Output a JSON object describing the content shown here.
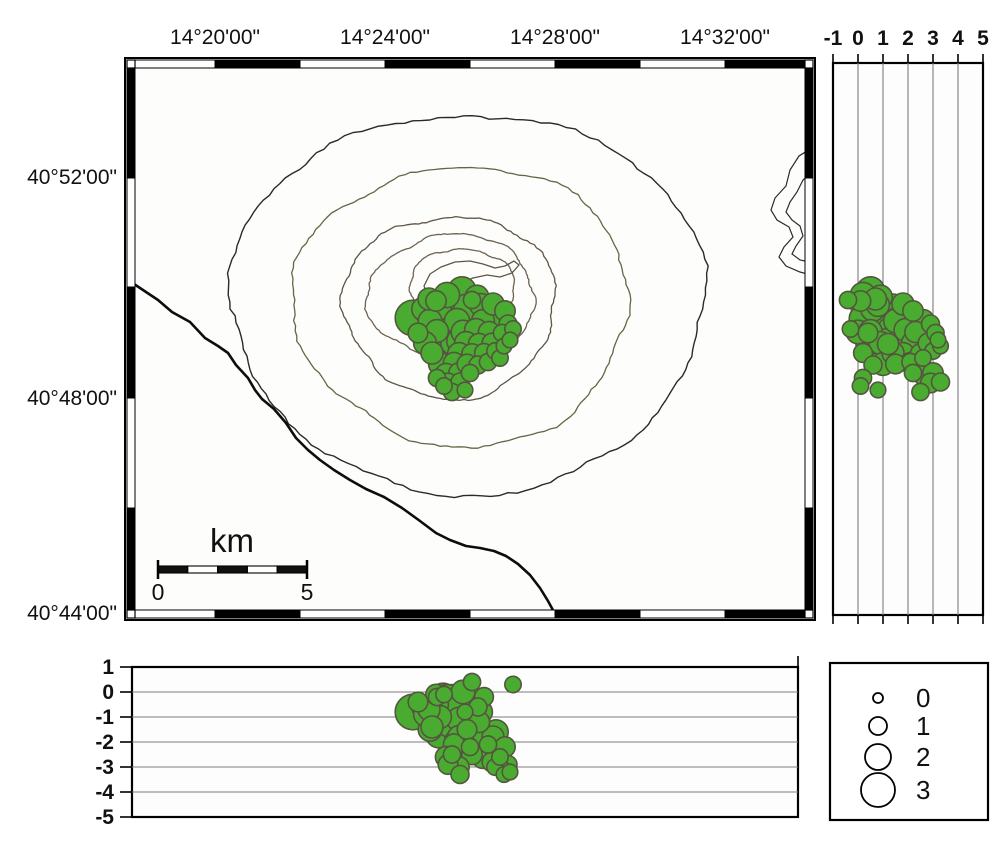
{
  "colors": {
    "quake_fill": "#49ac30",
    "quake_stroke": "#55553f",
    "coast": "#0d0d0d",
    "grid": "#7d7d7d",
    "frame": "#000000",
    "map_bg": "#fdfdfb"
  },
  "map": {
    "lon_ticks": [
      {
        "label": "14°20'00\"",
        "x": 215
      },
      {
        "label": "14°24'00\"",
        "x": 385
      },
      {
        "label": "14°28'00\"",
        "x": 555
      },
      {
        "label": "14°32'00\"",
        "x": 725
      }
    ],
    "lat_ticks": [
      {
        "label": "40°52'00\"",
        "y": 177
      },
      {
        "label": "40°48'00\"",
        "y": 398
      },
      {
        "label": "40°44'00\"",
        "y": 613
      }
    ],
    "frame": {
      "x0": 125,
      "y0": 58,
      "x1": 815,
      "y1": 620
    },
    "border_x": [
      135,
      215,
      300,
      385,
      470,
      555,
      640,
      725,
      805
    ],
    "border_y": [
      68,
      178,
      287,
      398,
      508,
      610
    ],
    "contours": [
      {
        "cx": 468,
        "cy": 302,
        "rx": 237,
        "ry": 190,
        "amp": 0.035,
        "seed": 11,
        "color": "#2b2b25",
        "w": 1.4
      },
      {
        "cx": 462,
        "cy": 305,
        "rx": 168,
        "ry": 140,
        "amp": 0.05,
        "seed": 22,
        "color": "#5c6b45",
        "w": 1.3
      },
      {
        "cx": 450,
        "cy": 306,
        "rx": 106,
        "ry": 91,
        "amp": 0.06,
        "seed": 33,
        "color": "#5f5546",
        "w": 1.3
      },
      {
        "cx": 452,
        "cy": 297,
        "rx": 84,
        "ry": 62,
        "amp": 0.065,
        "seed": 44,
        "color": "#6e6252",
        "w": 1.3
      },
      {
        "cx": 462,
        "cy": 289,
        "rx": 52,
        "ry": 41,
        "amp": 0.075,
        "seed": 55,
        "color": "#6e6252",
        "w": 1.3
      }
    ],
    "crater": [
      [
        424,
        286
      ],
      [
        430,
        274
      ],
      [
        441,
        267
      ],
      [
        455,
        262
      ],
      [
        470,
        261
      ],
      [
        483,
        264
      ],
      [
        495,
        268
      ],
      [
        505,
        266
      ],
      [
        514,
        261
      ],
      [
        519,
        265
      ],
      [
        512,
        273
      ],
      [
        500,
        277
      ],
      [
        487,
        275
      ],
      [
        473,
        278
      ],
      [
        461,
        283
      ],
      [
        453,
        291
      ],
      [
        444,
        296
      ],
      [
        433,
        294
      ],
      [
        426,
        291
      ]
    ],
    "coastline": [
      [
        125,
        278
      ],
      [
        140,
        288
      ],
      [
        158,
        300
      ],
      [
        172,
        312
      ],
      [
        190,
        322
      ],
      [
        205,
        338
      ],
      [
        218,
        346
      ],
      [
        228,
        353
      ],
      [
        236,
        365
      ],
      [
        248,
        378
      ],
      [
        255,
        390
      ],
      [
        262,
        399
      ],
      [
        274,
        409
      ],
      [
        286,
        423
      ],
      [
        296,
        438
      ],
      [
        308,
        450
      ],
      [
        320,
        460
      ],
      [
        334,
        470
      ],
      [
        350,
        480
      ],
      [
        366,
        489
      ],
      [
        384,
        497
      ],
      [
        402,
        508
      ],
      [
        420,
        521
      ],
      [
        436,
        533
      ],
      [
        450,
        540
      ],
      [
        466,
        546
      ],
      [
        480,
        548
      ],
      [
        494,
        551
      ],
      [
        506,
        556
      ],
      [
        518,
        564
      ],
      [
        530,
        575
      ],
      [
        540,
        588
      ],
      [
        548,
        601
      ],
      [
        554,
        612
      ],
      [
        558,
        620
      ]
    ],
    "hills_outer": [
      [
        815,
        146
      ],
      [
        799,
        156
      ],
      [
        790,
        170
      ],
      [
        786,
        186
      ],
      [
        775,
        198
      ],
      [
        771,
        210
      ],
      [
        777,
        220
      ],
      [
        789,
        227
      ],
      [
        793,
        237
      ],
      [
        784,
        247
      ],
      [
        779,
        257
      ],
      [
        786,
        266
      ],
      [
        800,
        272
      ],
      [
        815,
        276
      ]
    ],
    "hills_inner": [
      [
        815,
        170
      ],
      [
        803,
        180
      ],
      [
        797,
        192
      ],
      [
        790,
        202
      ],
      [
        786,
        212
      ],
      [
        792,
        220
      ],
      [
        800,
        226
      ],
      [
        803,
        236
      ],
      [
        796,
        246
      ],
      [
        792,
        254
      ],
      [
        800,
        260
      ],
      [
        815,
        263
      ]
    ],
    "scalebar": {
      "label": "km",
      "start_label": "0",
      "end_label": "5",
      "x0": 158,
      "x1": 307,
      "y": 566,
      "h": 7,
      "segments": 5
    }
  },
  "right_panel": {
    "x0": 833,
    "y0": 63,
    "x1": 983,
    "y1": 615,
    "zero_x": 858,
    "px_per_km": 25,
    "ticks": [
      {
        "label": "-1",
        "v": -1
      },
      {
        "label": "0",
        "v": 0
      },
      {
        "label": "1",
        "v": 1
      },
      {
        "label": "2",
        "v": 2
      },
      {
        "label": "3",
        "v": 3
      },
      {
        "label": "4",
        "v": 4
      },
      {
        "label": "5",
        "v": 5
      }
    ]
  },
  "bottom_panel": {
    "x0": 132,
    "y0": 667,
    "x1": 798,
    "y1": 817,
    "zero_y": 692,
    "px_per_km": 25,
    "ticks": [
      {
        "label": "1",
        "v": 1
      },
      {
        "label": "0",
        "v": 0
      },
      {
        "label": "-1",
        "v": -1
      },
      {
        "label": "-2",
        "v": -2
      },
      {
        "label": "-3",
        "v": -3
      },
      {
        "label": "-4",
        "v": -4
      },
      {
        "label": "-5",
        "v": -5
      }
    ]
  },
  "legend": {
    "x0": 830,
    "y0": 663,
    "x1": 988,
    "y1": 820,
    "circle_cx": 878,
    "label_x": 916,
    "entries": [
      {
        "label": "0",
        "mag": 0,
        "cy": 698
      },
      {
        "label": "1",
        "mag": 1,
        "cy": 726
      },
      {
        "label": "2",
        "mag": 2,
        "cy": 757
      },
      {
        "label": "3",
        "mag": 3,
        "cy": 790
      }
    ]
  },
  "magnitude_scale": {
    "r_base": 5,
    "r_per_mag": 4
  },
  "chart_data": {
    "type": "scatter",
    "title": "Volcano seismicity map with depth sections",
    "x_axis_lon": [
      "14°20'00\"",
      "14°24'00\"",
      "14°28'00\"",
      "14°32'00\""
    ],
    "y_axis_lat": [
      "40°52'00\"",
      "40°48'00\"",
      "40°44'00\""
    ],
    "depth_axis_right_km": [
      -1,
      0,
      1,
      2,
      3,
      4,
      5
    ],
    "depth_axis_bottom_km": [
      1,
      0,
      -1,
      -2,
      -3,
      -4,
      -5
    ],
    "magnitude_legend": [
      0,
      1,
      2,
      3
    ],
    "scale_bar_km": [
      0,
      5
    ],
    "earthquakes_px_depth_mag": [
      [
        413,
        318,
        0.8,
        3.2
      ],
      [
        447,
        295,
        0.2,
        1.9
      ],
      [
        462,
        291,
        0.5,
        2.3
      ],
      [
        477,
        297,
        0.9,
        1.7
      ],
      [
        436,
        301,
        0.1,
        1.3
      ],
      [
        429,
        299,
        0.7,
        1.5
      ],
      [
        472,
        300,
        -0.4,
        0.9
      ],
      [
        424,
        309,
        0.6,
        1.8
      ],
      [
        438,
        307,
        1.0,
        2.1
      ],
      [
        452,
        305,
        0.3,
        2.5
      ],
      [
        467,
        307,
        1.4,
        2.0
      ],
      [
        481,
        305,
        0.8,
        1.6
      ],
      [
        493,
        304,
        1.8,
        1.5
      ],
      [
        505,
        311,
        2.2,
        1.3
      ],
      [
        430,
        321,
        1.5,
        1.7
      ],
      [
        443,
        319,
        0.2,
        2.2
      ],
      [
        457,
        321,
        2.0,
        1.9
      ],
      [
        470,
        317,
        1.1,
        2.1
      ],
      [
        483,
        321,
        2.6,
        1.6
      ],
      [
        496,
        319,
        1.6,
        1.8
      ],
      [
        508,
        324,
        2.9,
        1.0
      ],
      [
        418,
        333,
        0.4,
        1.2
      ],
      [
        437,
        331,
        0.5,
        1.6
      ],
      [
        450,
        330,
        1.3,
        2.0
      ],
      [
        463,
        332,
        0.0,
        1.7
      ],
      [
        476,
        330,
        1.9,
        1.6
      ],
      [
        489,
        332,
        2.3,
        1.4
      ],
      [
        502,
        333,
        3.1,
        0.9
      ],
      [
        513,
        329,
        -0.3,
        0.8
      ],
      [
        425,
        343,
        0.9,
        1.6
      ],
      [
        439,
        341,
        1.7,
        2.1
      ],
      [
        453,
        343,
        0.4,
        1.8
      ],
      [
        459,
        341,
        1.1,
        1.8
      ],
      [
        466,
        343,
        2.2,
        1.6
      ],
      [
        479,
        344,
        1.2,
        1.4
      ],
      [
        492,
        343,
        2.8,
        1.2
      ],
      [
        504,
        346,
        3.3,
        0.7
      ],
      [
        510,
        340,
        3.2,
        0.7
      ],
      [
        432,
        353,
        1.4,
        1.5
      ],
      [
        446,
        353,
        0.7,
        1.9
      ],
      [
        459,
        354,
        1.8,
        1.6
      ],
      [
        472,
        354,
        2.5,
        1.3
      ],
      [
        484,
        353,
        0.2,
        1.1
      ],
      [
        495,
        351,
        3.0,
        0.8
      ],
      [
        488,
        362,
        2.1,
        0.9
      ],
      [
        500,
        358,
        2.6,
        0.8
      ],
      [
        440,
        364,
        1.0,
        1.6
      ],
      [
        454,
        363,
        2.1,
        1.4
      ],
      [
        467,
        364,
        1.5,
        1.2
      ],
      [
        478,
        365,
        0.6,
        1.0
      ],
      [
        446,
        374,
        2.6,
        1.4
      ],
      [
        459,
        373,
        3.0,
        1.3
      ],
      [
        470,
        373,
        2.2,
        0.9
      ],
      [
        437,
        378,
        0.2,
        0.9
      ],
      [
        448,
        383,
        2.9,
        1.2
      ],
      [
        460,
        382,
        3.3,
        1.0
      ],
      [
        444,
        386,
        0.1,
        0.8
      ],
      [
        452,
        392,
        2.5,
        0.9
      ],
      [
        465,
        390,
        0.8,
        0.7
      ]
    ]
  }
}
